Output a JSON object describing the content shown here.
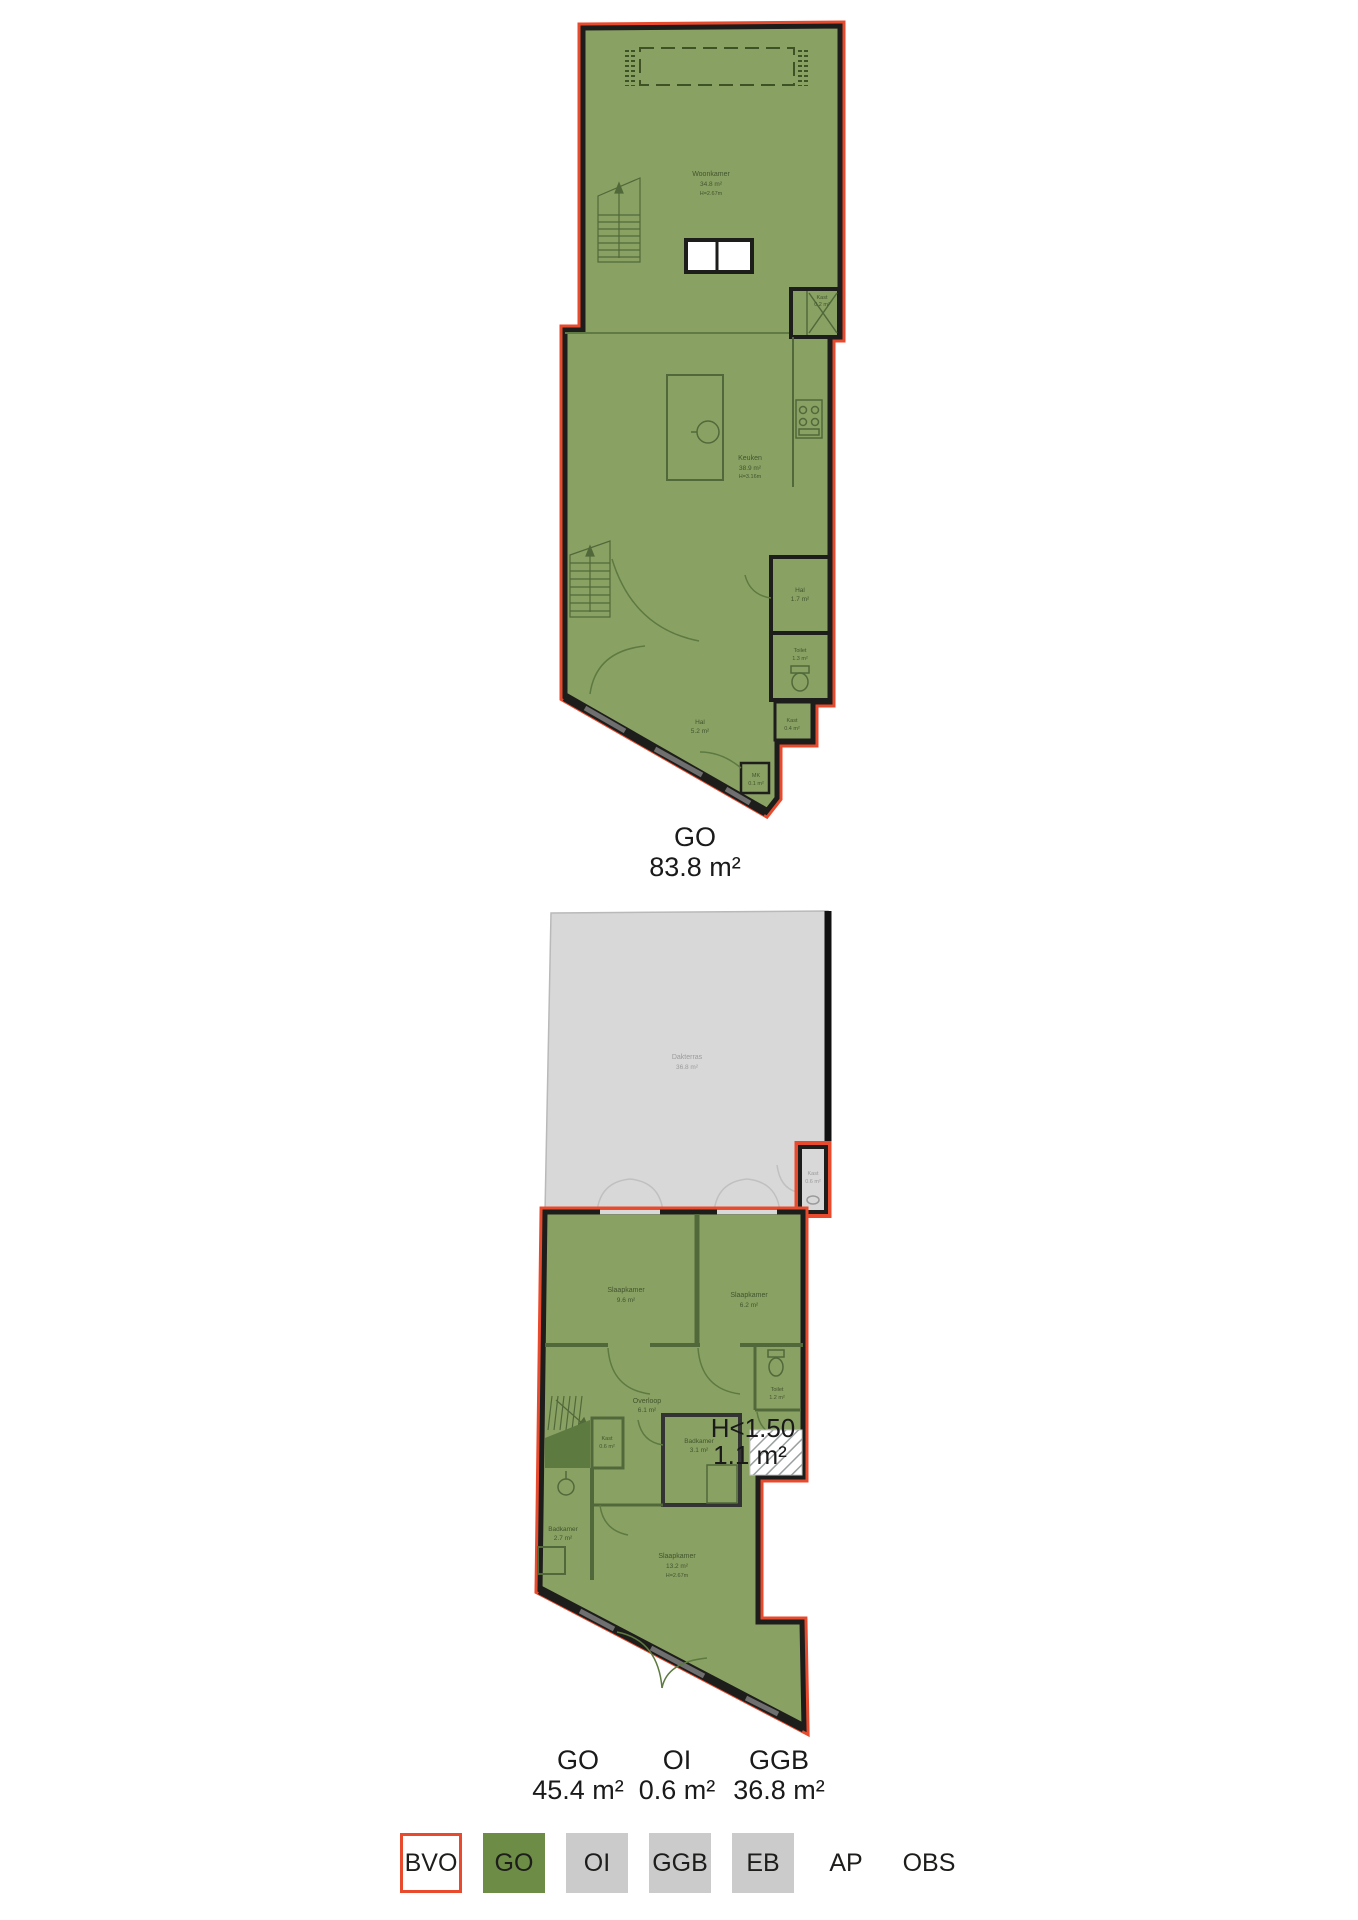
{
  "page": {
    "background": "#ffffff"
  },
  "colors": {
    "bvo_outline": "#e84a2e",
    "go_fill_legend": "#6d8c46",
    "go_fill_plan": "#8aa164",
    "neutral_fill": "#cbcbcb",
    "terrace_fill": "#d8d8d8",
    "wall": "#1d1d1b",
    "interior_line": "#51693a"
  },
  "plan1": {
    "summary": {
      "label": "GO",
      "area": "83.8 m²"
    },
    "rooms": {
      "woonkamer": {
        "name": "Woonkamer",
        "area": "34.8 m²",
        "height": "H=2.67m"
      },
      "kast_top": {
        "name": "Kast",
        "area": "0.2 m²"
      },
      "keuken": {
        "name": "Keuken",
        "area": "38.9 m²",
        "height": "H=3.16m"
      },
      "hal_boven": {
        "name": "Hal",
        "area": "1.7 m²"
      },
      "toilet": {
        "name": "Toilet",
        "area": "1.3 m²"
      },
      "hal": {
        "name": "Hal",
        "area": "5.2 m²"
      },
      "kast": {
        "name": "Kast",
        "area": "0.4 m²"
      },
      "mk": {
        "name": "MK",
        "area": "0.1 m²"
      }
    }
  },
  "plan2": {
    "summaries": [
      {
        "label": "GO",
        "area": "45.4 m²"
      },
      {
        "label": "OI",
        "area": "0.6 m²"
      },
      {
        "label": "GGB",
        "area": "36.8 m²"
      }
    ],
    "low_headroom": {
      "line1": "H<1.50",
      "line2": "1.1 m²"
    },
    "rooms": {
      "dakterras": {
        "name": "Dakterras",
        "area": "36.8 m²"
      },
      "kast_oi": {
        "name": "Kast",
        "area": "0.6 m²"
      },
      "slaapkamer_1": {
        "name": "Slaapkamer",
        "area": "9.6 m²"
      },
      "slaapkamer_2": {
        "name": "Slaapkamer",
        "area": "6.2 m²"
      },
      "toilet": {
        "name": "Toilet",
        "area": "1.2 m²"
      },
      "overloop": {
        "name": "Overloop",
        "area": "6.1 m²"
      },
      "kast": {
        "name": "Kast",
        "area": "0.6 m²"
      },
      "badkamer_1": {
        "name": "Badkamer",
        "area": "3.1 m²"
      },
      "badkamer_2": {
        "name": "Badkamer",
        "area": "2.7 m²"
      },
      "slaapkamer_3": {
        "name": "Slaapkamer",
        "area": "13.2 m²",
        "height": "H=2.67m"
      }
    }
  },
  "legend": {
    "items": [
      {
        "label": "BVO"
      },
      {
        "label": "GO"
      },
      {
        "label": "OI"
      },
      {
        "label": "GGB"
      },
      {
        "label": "EB"
      },
      {
        "label": "AP"
      },
      {
        "label": "OBS"
      }
    ]
  }
}
